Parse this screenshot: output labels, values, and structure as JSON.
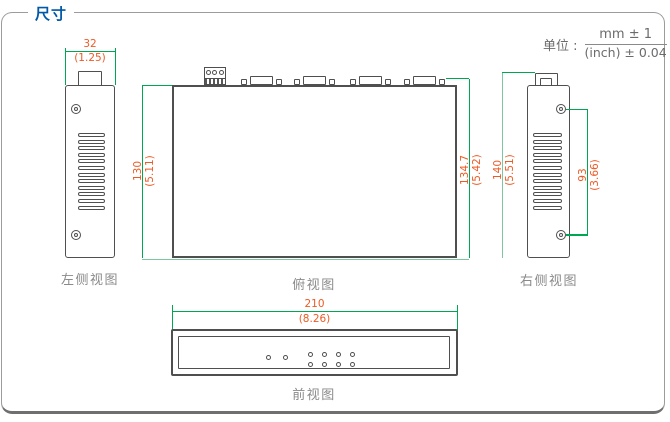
{
  "header": {
    "title": "尺寸"
  },
  "units": {
    "label": "单位 :",
    "numerator": "mm ± 1",
    "denominator": "(inch) ± 0.04"
  },
  "views": {
    "left_side": {
      "label": "左侧视图"
    },
    "top": {
      "label": "俯视图"
    },
    "right_side": {
      "label": "右侧视图"
    },
    "front": {
      "label": "前视图"
    }
  },
  "dimensions": {
    "left_width": {
      "mm": "32",
      "inch": "(1.25)"
    },
    "top_depth": {
      "mm": "130",
      "inch": "(5.11)"
    },
    "top_depth_overall": {
      "mm": "134.7",
      "inch": "(5.42)"
    },
    "right_height": {
      "mm": "140",
      "inch": "(5.51)"
    },
    "right_screw_span": {
      "mm": "93",
      "inch": "(3.66)"
    },
    "front_width": {
      "mm": "210",
      "inch": "(8.26)"
    }
  },
  "drawing_details": {
    "vent_slot_count": 12,
    "vga_connector_count": 4,
    "terminal_pin_count": 3,
    "front_single_led_count": 2,
    "front_paired_led_columns": 4
  },
  "colors": {
    "dimension_line": "#00a651",
    "dimension_line_light": "#7cc7a0",
    "dimension_text": "#ee5a24",
    "outline": "#4f4f4f",
    "view_label": "#8a8a8a",
    "title": "#0058a8",
    "units_text": "#6b6b6b",
    "frame_border": "#9c9c9c"
  }
}
